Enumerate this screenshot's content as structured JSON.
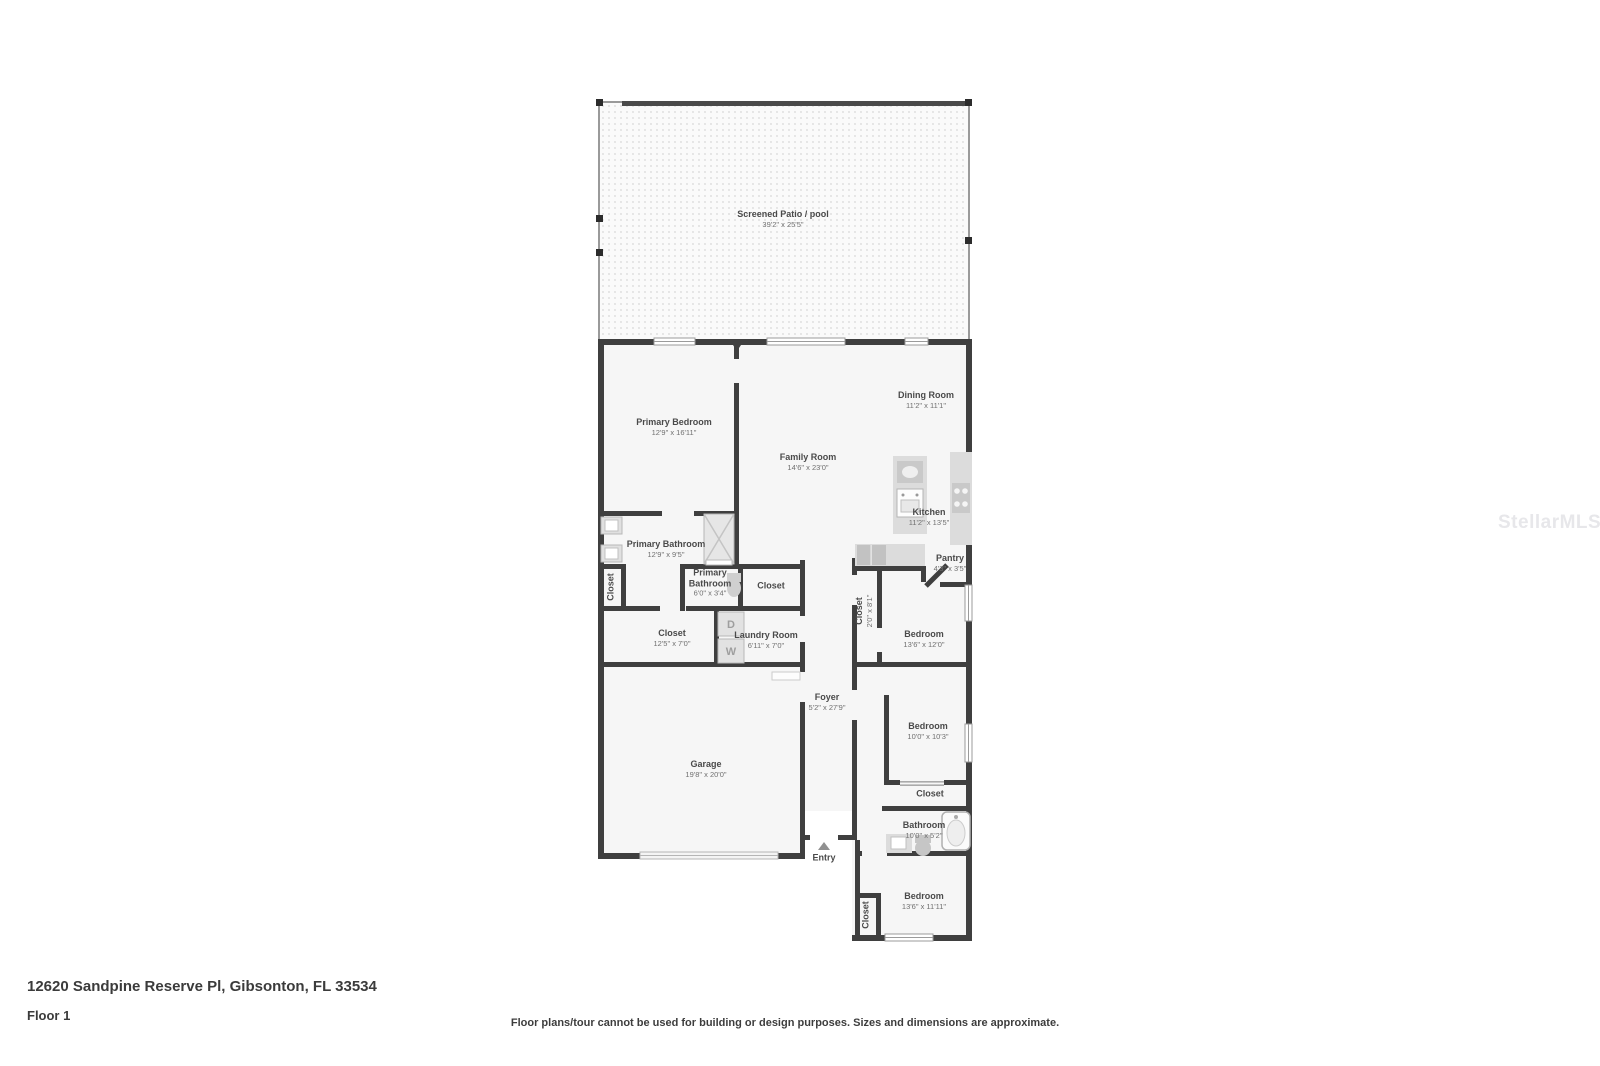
{
  "watermark": "StellarMLS",
  "footer": {
    "address": "12620 Sandpine Reserve Pl, Gibsonton, FL 33534",
    "floor_label": "Floor 1",
    "disclaimer": "Floor plans/tour cannot be used for building or design purposes. Sizes and dimensions are approximate."
  },
  "plan": {
    "entry_label": "Entry",
    "laundry_appliances": {
      "dryer": "D",
      "washer": "W"
    },
    "colors": {
      "wall": "#3f3f3f",
      "fixture_fill": "#dcdcdc",
      "label_text": "#4a4a4a"
    },
    "rooms": {
      "screened_patio": {
        "name": "Screened Patio / pool",
        "dims": "39'2\" x 25'5\""
      },
      "primary_bedroom": {
        "name": "Primary Bedroom",
        "dims": "12'9\" x 16'11\""
      },
      "family_room": {
        "name": "Family Room",
        "dims": "14'6\" x 23'0\""
      },
      "dining_room": {
        "name": "Dining Room",
        "dims": "11'2\" x 11'1\""
      },
      "kitchen": {
        "name": "Kitchen",
        "dims": "11'2\" x 13'5\""
      },
      "pantry": {
        "name": "Pantry",
        "dims": "4'3\" x 3'5\""
      },
      "primary_bathroom": {
        "name": "Primary Bathroom",
        "dims": "12'9\" x 9'5\""
      },
      "water_closet": {
        "name": "Primary Bathroom",
        "dims": "6'0\" x 3'4\""
      },
      "mini_closet": {
        "name": "Closet"
      },
      "hall_closet": {
        "name": "Closet",
        "dims": "12'5\" x 7'0\""
      },
      "laundry_room": {
        "name": "Laundry Room",
        "dims": "6'11\" x 7'0\""
      },
      "closet_strip": {
        "name": "Closet",
        "dims": "2'0\" x 8'1\""
      },
      "foyer": {
        "name": "Foyer",
        "dims": "5'2\" x 27'9\""
      },
      "garage": {
        "name": "Garage",
        "dims": "19'8\" x 20'0\""
      },
      "bedroom_1": {
        "name": "Bedroom",
        "dims": "13'6\" x 12'0\""
      },
      "bedroom_2": {
        "name": "Bedroom",
        "dims": "10'0\" x 10'3\""
      },
      "bedroom_2_closet": {
        "name": "Closet"
      },
      "bathroom": {
        "name": "Bathroom",
        "dims": "10'0\" x 5'2\""
      },
      "bedroom_3": {
        "name": "Bedroom",
        "dims": "13'6\" x 11'11\""
      },
      "bedroom_3_closet": {
        "name": "Closet"
      }
    }
  }
}
